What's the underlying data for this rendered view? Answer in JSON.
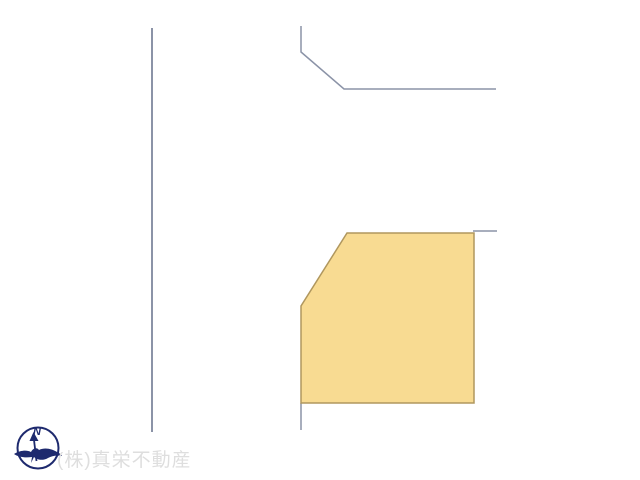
{
  "page": {
    "kind": "real-estate site plan",
    "background": "#ffffff",
    "width": 640,
    "height": 480
  },
  "watermark": {
    "company_label": "(株)真栄不動産",
    "color": "#dedede"
  },
  "compass": {
    "north_label": "N",
    "color": "#1e2a6e"
  },
  "lot": {
    "fill": "#f8db92",
    "stroke": "#b0975e",
    "stroke_width": "1.5",
    "points": "347,233 474,233 474,403 301,403 301,306"
  },
  "boundaries": {
    "color": "#8b93a7",
    "segments": [
      {
        "name": "left-road-boundary",
        "points": "152,28 152,432",
        "width": "2"
      },
      {
        "name": "upper-road-boundary",
        "points": "301,26 301,52 344,89 496,89",
        "width": "1.5"
      },
      {
        "name": "right-neighbor-boundary",
        "points": "473,231 497,231",
        "width": "1.5"
      },
      {
        "name": "lower-boundary-stub",
        "points": "301,403 301,430",
        "width": "1.5"
      }
    ]
  }
}
